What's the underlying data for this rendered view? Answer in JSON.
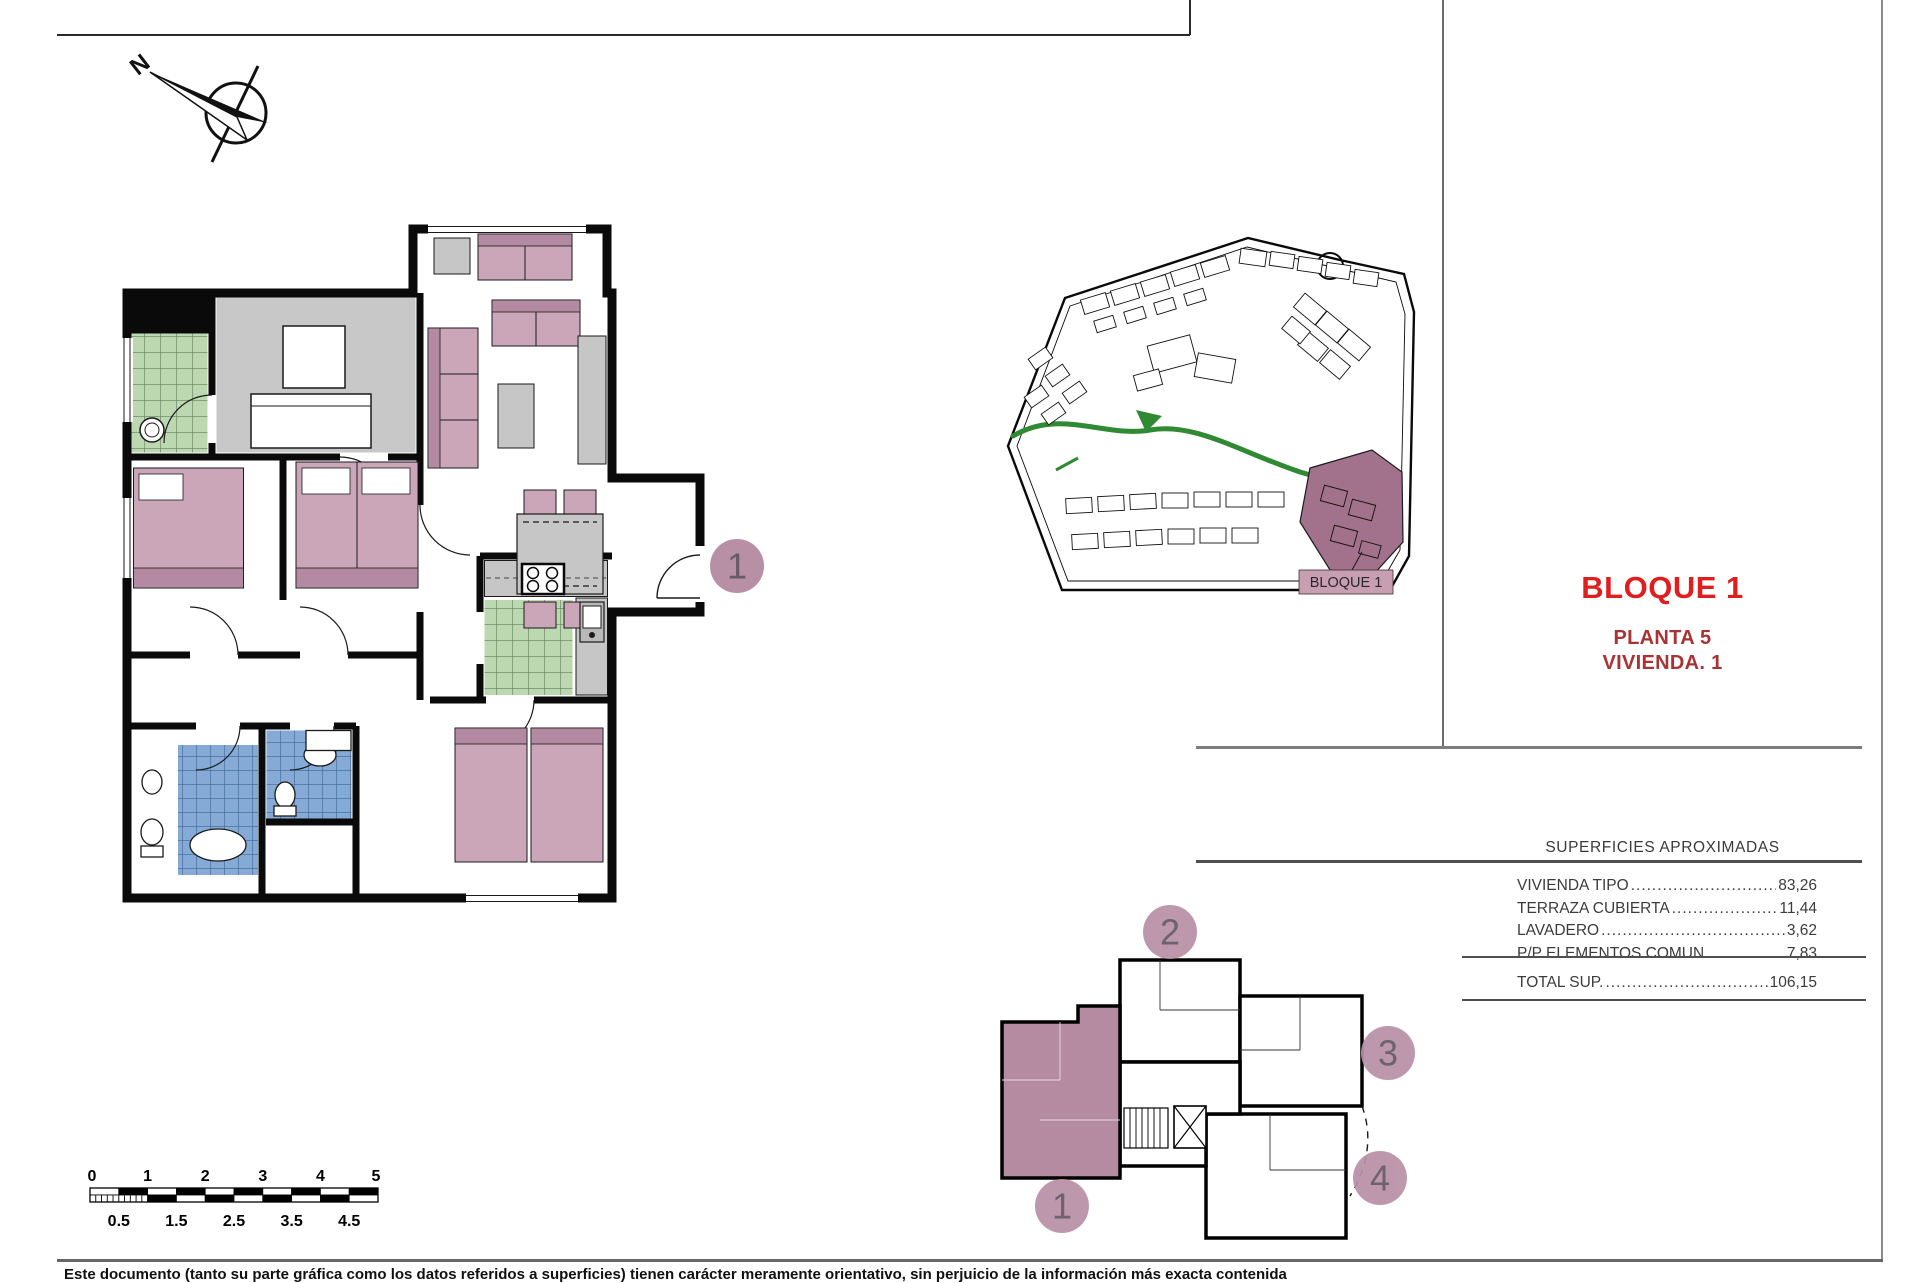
{
  "north": {
    "label": "N"
  },
  "title_block": {
    "block": "BLOQUE 1",
    "floor": "PLANTA 5",
    "unit": "VIVIENDA. 1"
  },
  "surfaces": {
    "header": "SUPERFICIES APROXIMADAS",
    "rows": [
      {
        "label": "VIVIENDA TIPO",
        "value": "83,26"
      },
      {
        "label": "TERRAZA CUBIERTA",
        "value": "11,44"
      },
      {
        "label": "LAVADERO",
        "value": "3,62"
      },
      {
        "label": "P/P ELEMENTOS COMUN.",
        "value": "7,83"
      }
    ],
    "total": {
      "label": "TOTAL SUP.",
      "value": "106,15"
    }
  },
  "site_plan": {
    "highlight_label": "BLOQUE 1"
  },
  "key_plan": {
    "badges": [
      "1",
      "2",
      "3",
      "4"
    ]
  },
  "floor_plan": {
    "unit_badge": "1"
  },
  "scale_bar": {
    "top": [
      "0",
      "1",
      "2",
      "3",
      "4",
      "5"
    ],
    "bottom": [
      "0.5",
      "1.5",
      "2.5",
      "3.5",
      "4.5"
    ]
  },
  "disclaimer": "Este documento (tanto su parte gráfica como los datos referidos a superficies) tienen carácter meramente orientativo, sin perjuicio de la información más exacta contenida",
  "colors": {
    "accent_red": "#e01e1e",
    "sub_red": "#a93232",
    "mauve_badge": "#b890a5",
    "mauve_site": "#a2718b",
    "furniture_pink": "#cba6b9",
    "furniture_pink_dark": "#b38aa1",
    "tile_green": "#bcd8b0",
    "tile_blue": "#84aad5",
    "floor_gray": "#c8c8c8",
    "site_green": "#2f8a33"
  }
}
